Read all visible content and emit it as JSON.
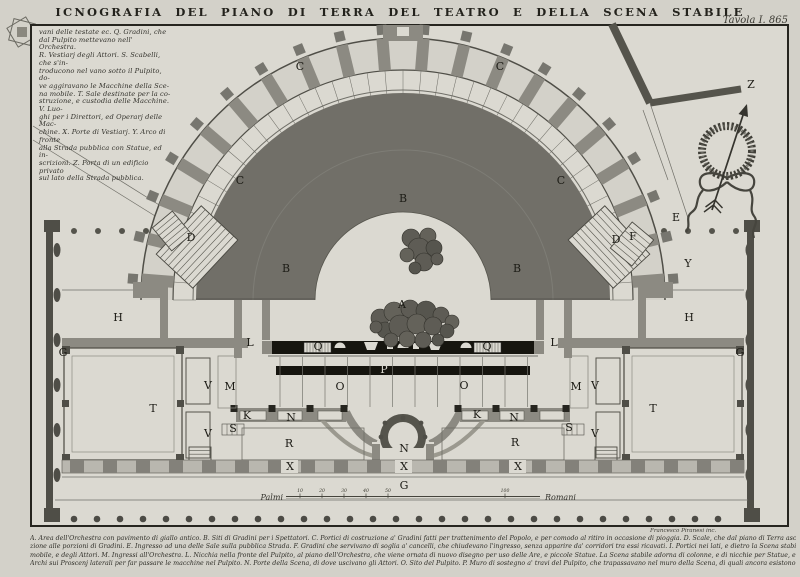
{
  "plate": {
    "title": "ICNOGRAFIA DEL PIANO DI TERRA DEL TEATRO E DELLA SCENA STABILE",
    "plate_number": "Tavola I. 865",
    "signature": "Francesco Piranesi inc."
  },
  "colors": {
    "paper_outer": "#d3d1c9",
    "paper_inner": "#dbd9d1",
    "ink": "#22211b",
    "wall": "#8c8a82",
    "wall_dark": "#4f4e47",
    "seating": "#716f68",
    "black_band": "#16150f",
    "rock": "#5e5c55"
  },
  "legend_left": {
    "lines": [
      "vani delle testate ec. Q. Gradini, che",
      "dal Pulpito mettevano nell' Orchestra.",
      "R. Vestiarj degli Attori. S. Scabelli, che s'in-",
      "troducono nel vano sotto il Pulpito, do-",
      "ve aggiravano le Macchine della Sce-",
      "na mobile. T. Sale destinate per la co-",
      "struzione, e custodia delle Macchine. V. Luo-",
      "ghi per i Direttori, ed Operarj delle Mac-",
      "chine. X. Porte di Vestiarj. Y. Arco di fronte",
      "alla Strada pubblica con Statue, ed in-",
      "scrizioni. Z. Porta di un edificio privato",
      "sul lato della Strada pubblica."
    ]
  },
  "caption_bottom": {
    "lines": [
      "A. Area dell'Orchestra con pavimento di giallo antico. B. Siti di Gradini per i Spettatori. C. Portici di costruzione a' Gradini fatti per trattenimento del Popolo, e per comodo al ritiro in occasione di pioggia. D. Scale, che dal piano di Terra ascendono ai corridori di communica-",
      "zione alle porzioni di Gradini. E. Ingresso ad una delle Sale sulla pubblica Strada. F. Gradini che servivano di soglia a' cancelli, che chiudevano l'ingresso, senza apparire da' corridori tra essi ricavati. I. Portici nei lati, e dietro la Scena stabile per trattenimento di",
      "mobile, e degli Attori. M. Ingressi all'Orchestra. L. Nicchia nella fronte del Pulpito, al piano dell'Orchestra, che viene ornata di nuovo disegno per uso delle Are, e piccole Statue. La Scena stabile adorna di colonne, e di nicchie per Statue, e di ricchi marmi. Proscenj di fianchi",
      "Archi sui Proscenj laterali per far passare le macchine nel Pulpito. N. Porte della Scena, di dove uscivano gli Attori. O. Sito del Pulpito. P. Muro di sostegno a' travi del Pulpito, che trapassavano nel muro della Scena, di quali ancora esistono li"
    ]
  },
  "scale_bar": {
    "prefix": "Palmi",
    "suffix": "Romani",
    "ticks": [
      {
        "label": "10",
        "x": 300
      },
      {
        "label": "20",
        "x": 322
      },
      {
        "label": "30",
        "x": 344
      },
      {
        "label": "40",
        "x": 366
      },
      {
        "label": "50",
        "x": 388
      },
      {
        "label": "100",
        "x": 505
      }
    ]
  },
  "plan": {
    "labels": [
      {
        "t": "A",
        "x": 402,
        "y": 308
      },
      {
        "t": "B",
        "x": 286,
        "y": 272
      },
      {
        "t": "B",
        "x": 403,
        "y": 202
      },
      {
        "t": "B",
        "x": 517,
        "y": 272
      },
      {
        "t": "C",
        "x": 240,
        "y": 184
      },
      {
        "t": "C",
        "x": 300,
        "y": 70
      },
      {
        "t": "C",
        "x": 500,
        "y": 70
      },
      {
        "t": "C",
        "x": 561,
        "y": 184
      },
      {
        "t": "D",
        "x": 191,
        "y": 241
      },
      {
        "t": "D",
        "x": 616,
        "y": 243
      },
      {
        "t": "E",
        "x": 676,
        "y": 221
      },
      {
        "t": "F",
        "x": 633,
        "y": 240,
        "s": 9
      },
      {
        "t": "G",
        "x": 63,
        "y": 356
      },
      {
        "t": "G",
        "x": 740,
        "y": 356
      },
      {
        "t": "G",
        "x": 404,
        "y": 489
      },
      {
        "t": "H",
        "x": 118,
        "y": 321
      },
      {
        "t": "H",
        "x": 689,
        "y": 321
      },
      {
        "t": "K",
        "x": 247,
        "y": 419,
        "s": 9
      },
      {
        "t": "K",
        "x": 477,
        "y": 418,
        "s": 9
      },
      {
        "t": "L",
        "x": 250,
        "y": 346,
        "s": 9
      },
      {
        "t": "L",
        "x": 554,
        "y": 346,
        "s": 9
      },
      {
        "t": "M",
        "x": 230,
        "y": 390,
        "s": 9
      },
      {
        "t": "M",
        "x": 576,
        "y": 390,
        "s": 9
      },
      {
        "t": "N",
        "x": 291,
        "y": 421,
        "s": 9
      },
      {
        "t": "N",
        "x": 514,
        "y": 421,
        "s": 9
      },
      {
        "t": "N",
        "x": 404,
        "y": 452,
        "s": 9
      },
      {
        "t": "O",
        "x": 340,
        "y": 390
      },
      {
        "t": "O",
        "x": 464,
        "y": 389
      },
      {
        "t": "P",
        "x": 384,
        "y": 373,
        "s": 7.5,
        "w": true
      },
      {
        "t": "Q",
        "x": 318,
        "y": 350,
        "s": 7
      },
      {
        "t": "Q",
        "x": 487,
        "y": 350,
        "s": 7
      },
      {
        "t": "R",
        "x": 289,
        "y": 447
      },
      {
        "t": "R",
        "x": 515,
        "y": 446
      },
      {
        "t": "S",
        "x": 233,
        "y": 432,
        "s": 8
      },
      {
        "t": "S",
        "x": 569,
        "y": 431,
        "s": 8
      },
      {
        "t": "T",
        "x": 153,
        "y": 412
      },
      {
        "t": "T",
        "x": 653,
        "y": 412
      },
      {
        "t": "V",
        "x": 208,
        "y": 389,
        "s": 9.5
      },
      {
        "t": "V",
        "x": 208,
        "y": 437,
        "s": 9.5
      },
      {
        "t": "V",
        "x": 595,
        "y": 389,
        "s": 9.5
      },
      {
        "t": "V",
        "x": 595,
        "y": 437,
        "s": 9.5
      },
      {
        "t": "X",
        "x": 290,
        "y": 470,
        "s": 9.5
      },
      {
        "t": "X",
        "x": 404,
        "y": 470,
        "s": 9.5
      },
      {
        "t": "X",
        "x": 518,
        "y": 470,
        "s": 9.5
      },
      {
        "t": "Y",
        "x": 688,
        "y": 267
      },
      {
        "t": "Z",
        "x": 751,
        "y": 88
      }
    ]
  }
}
